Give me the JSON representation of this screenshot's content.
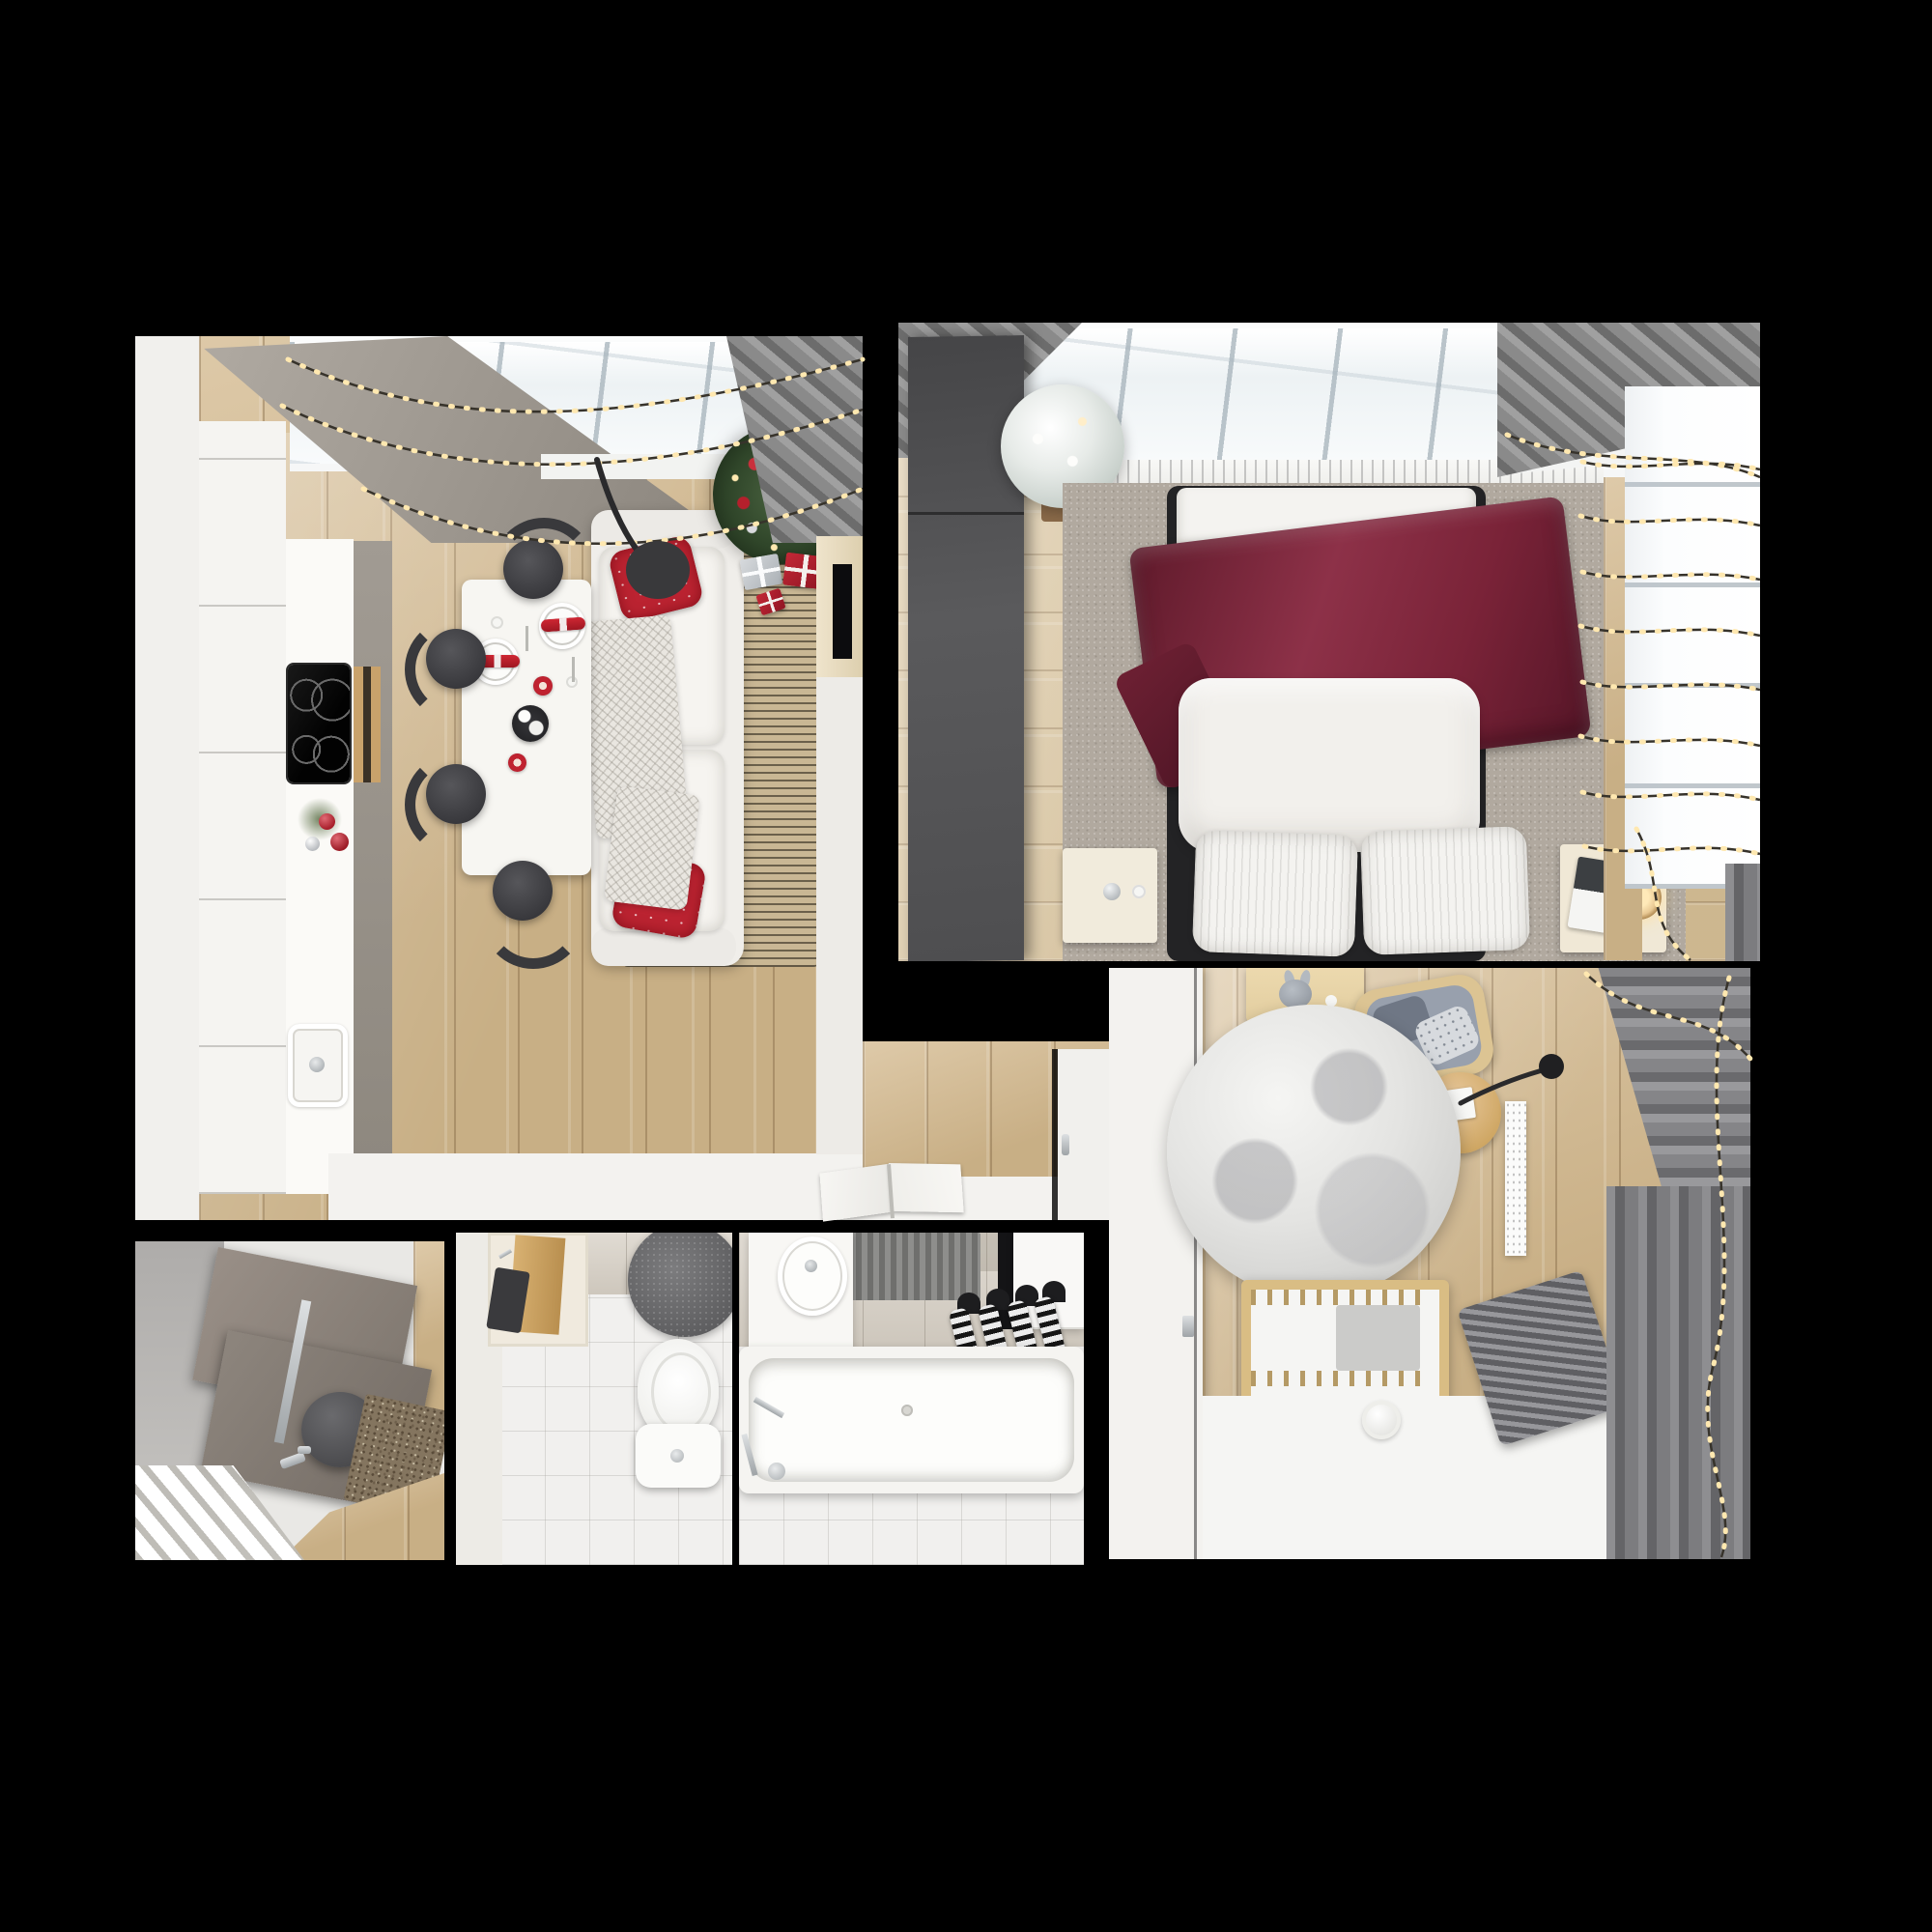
{
  "scene": {
    "title": "Top-down 3D floor-plan render of a small apartment decorated for Christmas",
    "background": "#000000",
    "text_visible": "none"
  },
  "palette": {
    "background": "#000000",
    "wood_floor": "#d3b88c",
    "white_furniture": "#f3f2ef",
    "accent_red": "#bb2331",
    "burgundy_blanket": "#7a2338",
    "curtain_gray": "#8a8a8d",
    "wardrobe_gray": "#525254",
    "rug_gray": "#b1a99f",
    "fairy_light_warm": "#ffe8b0",
    "tree_green": "#2f4529",
    "crib_wood": "#d9bd84"
  },
  "rooms": [
    {
      "label": "Living room and kitchen",
      "objects": [
        "skylight window",
        "string lights (3 sagging strands)",
        "gray curtain",
        "decorated christmas tree with star and red/silver baubles",
        "gift boxes (red and silver)",
        "white sofa with 2 red snowflake pillows and knit throw",
        "striped beige rug",
        "black arc floor lamp",
        "white dining table",
        "4 dark chairs",
        "2 place settings with plates and red napkins",
        "2 red candles",
        "dark serving tray",
        "greige upper cabinets",
        "white tall cabinets",
        "white countertop",
        "black induction cooktop with 4 burners",
        "oven with wood handle",
        "sink",
        "red bauble decoration on counter",
        "media cabinet with TV"
      ]
    },
    {
      "label": "Bedroom",
      "objects": [
        "skylight window",
        "dark gray wardrobe",
        "flocked white christmas tree in pot",
        "gray rug",
        "double bed with white striped bedding",
        "burgundy velvet throw",
        "2 striped pillows",
        "white duvet",
        "left nightstand with clock",
        "right nightstand with magazine and glowing lamp",
        "window with 8 fairy-light strands",
        "gray curtains",
        "white radiator sill"
      ]
    },
    {
      "label": "Nursery",
      "objects": [
        "white wardrobe wall",
        "wooden changing desk with gray bunny toy",
        "gray armchair with cushions",
        "round wooden side table with black desk lamp and papers",
        "large round gray-white rug",
        "wooden crib with white mattress and gray blanket",
        "white humidifier",
        "white slatted radiator",
        "gray ribbed radiator",
        "gray curtains",
        "fairy lights",
        "bright window"
      ]
    },
    {
      "label": "Entry hall",
      "objects": [
        "gray wall",
        "two taupe wall panels",
        "dark gray pouf",
        "brown mosaic doormat",
        "white slatted bench",
        "wood floor",
        "chrome door hardware"
      ]
    },
    {
      "label": "WC",
      "objects": [
        "beige tiled wall",
        "wooden shelf niche with dark towel",
        "dark round rug",
        "white toilet with cistern and chrome button",
        "white tiled floor"
      ]
    },
    {
      "label": "Bathroom",
      "objects": [
        "white vanity with oval sink",
        "chrome faucet",
        "beige tiled wall",
        "gray ribbed mat",
        "wall cabinet",
        "4 black-and-white striped towels on hooks",
        "white bathtub with chrome fittings",
        "white tiled floor"
      ]
    },
    {
      "label": "Hallway",
      "objects": [
        "wood floor",
        "white door with chrome handle",
        "open book on white floor strip"
      ]
    }
  ],
  "counts": {
    "rooms": 7,
    "dining_chairs": 4,
    "bed_pillows": 2,
    "towels": 4,
    "bedroom_light_strands": 8,
    "living_light_strands": 3
  }
}
